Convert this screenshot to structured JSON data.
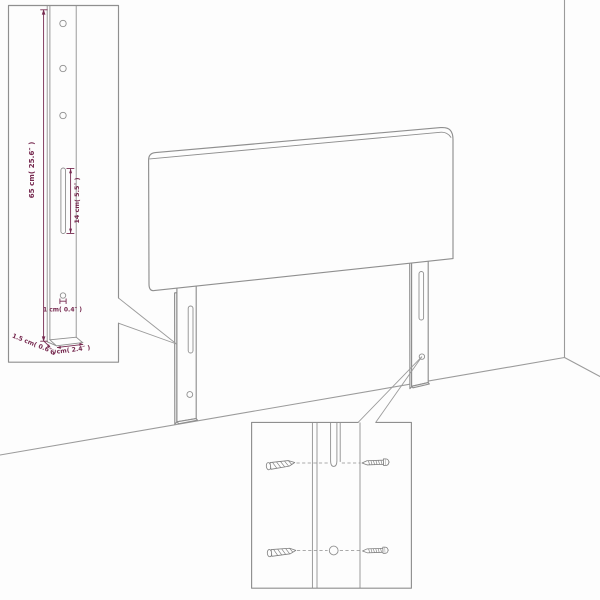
{
  "colors": {
    "dimension_accent": "#76294f",
    "line_gray": "#8f8f8f",
    "background": "#fdfdfd"
  },
  "insets": {
    "leg_detail": {
      "labels": {
        "height": "65 cm( 25.6″ )",
        "slot_length": "14 cm( 5.5″ )",
        "hole_diameter": "1 cm( 0.4″ )",
        "thickness": "1.5 cm( 0.6″ )",
        "width": "6 cm( 2.4″ )"
      }
    }
  }
}
